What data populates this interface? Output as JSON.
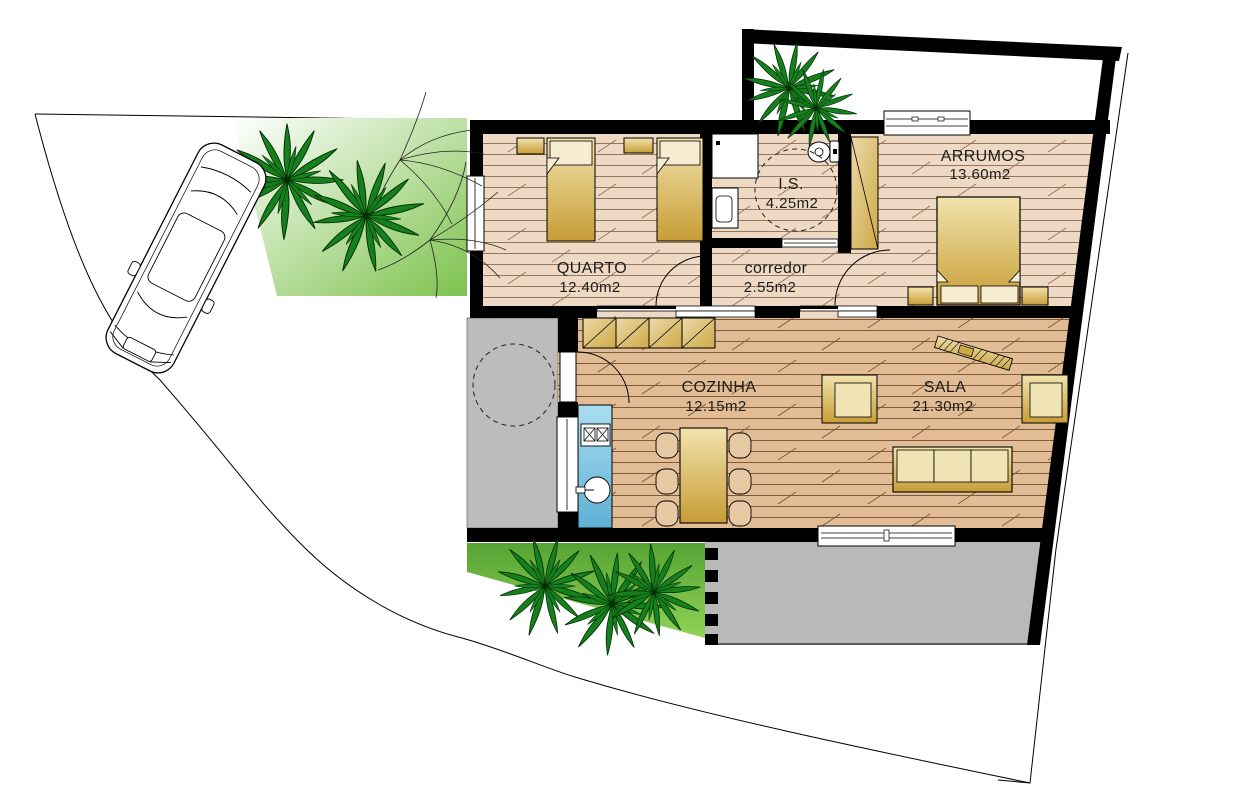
{
  "plan": {
    "type": "architectural-floor-plan",
    "rooms": {
      "quarto": {
        "label": "QUARTO",
        "area": "12.40m2"
      },
      "is": {
        "label": "I.S.",
        "area": "4.25m2"
      },
      "corredor": {
        "label": "corredor",
        "area": "2.55m2"
      },
      "arrumos": {
        "label": "ARRUMOS",
        "area": "13.60m2"
      },
      "cozinha": {
        "label": "COZINHA",
        "area": "12.15m2"
      },
      "sala": {
        "label": "SALA",
        "area": "21.30m2"
      }
    },
    "objects": [
      "car",
      "palm-tree",
      "shrub-branches",
      "single-bed",
      "double-bed",
      "nightstand",
      "wardrobe",
      "toilet",
      "shower",
      "washbasin",
      "kitchen-counter",
      "stove",
      "sink",
      "upper-cabinets",
      "dining-table",
      "chair",
      "sofa",
      "armchair",
      "sideboard",
      "sliding-door",
      "door-swing",
      "window",
      "terrace",
      "entrance-patio",
      "garden",
      "site-boundary"
    ],
    "palette": {
      "wall": "#000000",
      "floor_light": "#eed9c4",
      "floor_light_line": "#96765c",
      "floor_warm": "#e2bc95",
      "floor_warm_line": "#7e5a3a",
      "furniture_gold_light": "#f2e3ac",
      "furniture_gold_dark": "#c79d36",
      "cabinet_tan_light": "#ecd9a8",
      "cabinet_tan_dark": "#cfa947",
      "counter_blue_light": "#a9ddf0",
      "counter_blue_dark": "#5fb0d4",
      "paving_gray": "#bcbcbc",
      "garden_green": "#7dc24d",
      "garden_green_dark": "#55a433",
      "palm_green": "#15801d",
      "text": "#1c1c1c"
    }
  }
}
